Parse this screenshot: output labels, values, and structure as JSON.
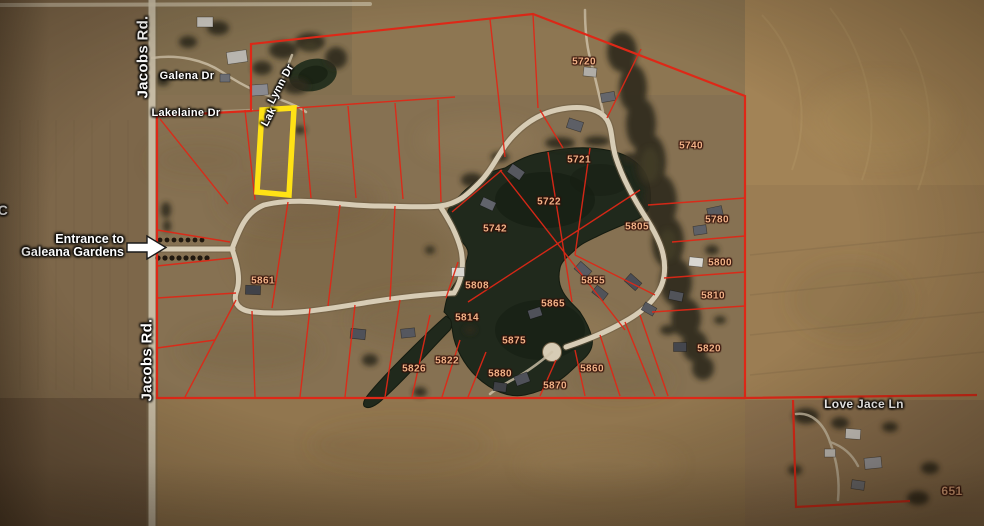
{
  "map": {
    "colors": {
      "plat_line_red": "#de2817",
      "highlight_yellow": "#ffe215",
      "road_label_white": "#ffffff",
      "lot_number_peach": "#f0b287"
    },
    "entrance": {
      "line1": "Entrance to",
      "line2": "Galeana Gardens",
      "arrow_icon": "right-arrow-icon"
    },
    "road_labels": [
      {
        "text": "Jacobs Rd.",
        "x": 143,
        "y": 57,
        "rotate": -90,
        "size": 15
      },
      {
        "text": "Jacobs Rd.",
        "x": 147,
        "y": 360,
        "rotate": -90,
        "size": 15
      },
      {
        "text": "Galena Dr",
        "x": 187,
        "y": 76,
        "size": 11
      },
      {
        "text": "Lakelaine Dr",
        "x": 186,
        "y": 113,
        "size": 11
      },
      {
        "text": "Lynn Dr",
        "x": 281,
        "y": 84,
        "rotate": -62,
        "size": 11
      },
      {
        "text": "Lak",
        "x": 269,
        "y": 117,
        "rotate": -62,
        "size": 11
      },
      {
        "text": "Love Jace Ln",
        "x": 864,
        "y": 404,
        "size": 12
      },
      {
        "text": "C",
        "x": 3,
        "y": 210,
        "size": 14
      }
    ],
    "lot_numbers": [
      {
        "text": "5720",
        "x": 584,
        "y": 62
      },
      {
        "text": "5721",
        "x": 579,
        "y": 160
      },
      {
        "text": "5740",
        "x": 691,
        "y": 146
      },
      {
        "text": "5722",
        "x": 549,
        "y": 202
      },
      {
        "text": "5742",
        "x": 495,
        "y": 229
      },
      {
        "text": "5805",
        "x": 637,
        "y": 227
      },
      {
        "text": "5780",
        "x": 717,
        "y": 220
      },
      {
        "text": "5800",
        "x": 720,
        "y": 263
      },
      {
        "text": "5810",
        "x": 713,
        "y": 296
      },
      {
        "text": "5820",
        "x": 709,
        "y": 349
      },
      {
        "text": "5861",
        "x": 263,
        "y": 281
      },
      {
        "text": "5808",
        "x": 477,
        "y": 286
      },
      {
        "text": "5855",
        "x": 593,
        "y": 281
      },
      {
        "text": "5865",
        "x": 553,
        "y": 304
      },
      {
        "text": "5814",
        "x": 467,
        "y": 318
      },
      {
        "text": "5875",
        "x": 514,
        "y": 341
      },
      {
        "text": "5826",
        "x": 414,
        "y": 369
      },
      {
        "text": "5822",
        "x": 447,
        "y": 361
      },
      {
        "text": "5880",
        "x": 500,
        "y": 374
      },
      {
        "text": "5860",
        "x": 592,
        "y": 369
      },
      {
        "text": "5870",
        "x": 555,
        "y": 386
      },
      {
        "text": "651",
        "x": 952,
        "y": 491,
        "size": 12
      }
    ]
  }
}
